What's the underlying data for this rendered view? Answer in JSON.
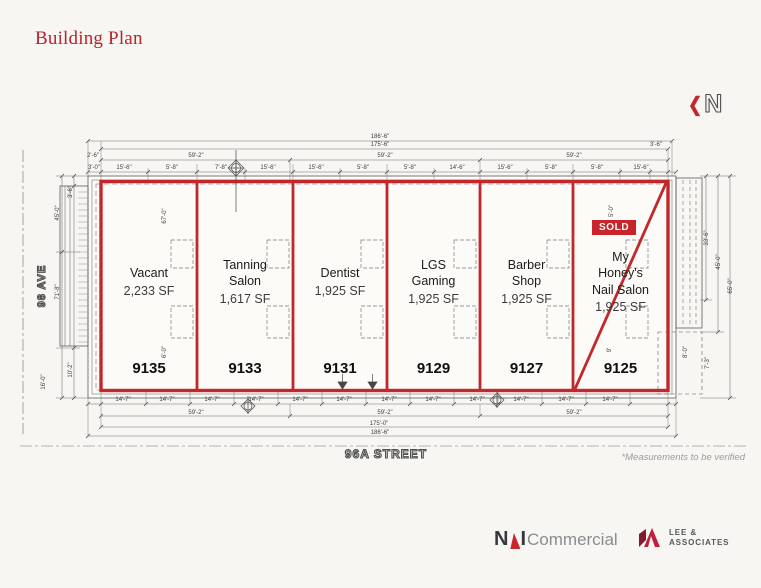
{
  "page": {
    "title": "Building Plan",
    "background": "#f7f6f3",
    "accent_red": "#b3262c",
    "plan_red": "#c2282b"
  },
  "north": {
    "label": "N",
    "arrow_icon": "❮"
  },
  "streets": {
    "left": "98 AVE",
    "bottom": "96A STREET"
  },
  "note": "*Measurements to be verified",
  "units": [
    {
      "number": "9135",
      "lines": [
        "Vacant"
      ],
      "sf": "2,233 SF",
      "status": "",
      "x": 101,
      "w": 96
    },
    {
      "number": "9133",
      "lines": [
        "Tanning",
        "Salon"
      ],
      "sf": "1,617 SF",
      "status": "",
      "x": 197,
      "w": 96
    },
    {
      "number": "9131",
      "lines": [
        "Dentist"
      ],
      "sf": "1,925 SF",
      "status": "",
      "x": 293,
      "w": 94
    },
    {
      "number": "9129",
      "lines": [
        "LGS",
        "Gaming"
      ],
      "sf": "1,925 SF",
      "status": "",
      "x": 387,
      "w": 93
    },
    {
      "number": "9127",
      "lines": [
        "Barber",
        "Shop"
      ],
      "sf": "1,925 SF",
      "status": "",
      "x": 480,
      "w": 93
    },
    {
      "number": "9125",
      "lines": [
        "My",
        "Honey's",
        "Nail Salon"
      ],
      "sf": "1,925 SF",
      "status": "SOLD",
      "x": 573,
      "w": 95
    }
  ],
  "dimensions": {
    "overall_width": "186'-6\"",
    "labels": [
      {
        "t": "186'-6\"",
        "x": 380,
        "y": 137
      },
      {
        "t": "175'-6\"",
        "x": 380,
        "y": 145
      },
      {
        "t": "2'-6\"",
        "x": 93,
        "y": 156
      },
      {
        "t": "59'-2\"",
        "x": 196,
        "y": 156
      },
      {
        "t": "59'-2\"",
        "x": 385,
        "y": 156
      },
      {
        "t": "59'-2\"",
        "x": 574,
        "y": 156
      },
      {
        "t": "3'-6\"",
        "x": 656,
        "y": 145
      },
      {
        "t": "3'-0\"",
        "x": 94,
        "y": 168
      },
      {
        "t": "15'-6\"",
        "x": 124,
        "y": 168
      },
      {
        "t": "5'-8\"",
        "x": 172,
        "y": 168
      },
      {
        "t": "7'-8\"",
        "x": 221,
        "y": 168
      },
      {
        "t": "15'-6\"",
        "x": 268,
        "y": 168
      },
      {
        "t": "15'-6\"",
        "x": 316,
        "y": 168
      },
      {
        "t": "5'-8\"",
        "x": 363,
        "y": 168
      },
      {
        "t": "5'-8\"",
        "x": 410,
        "y": 168
      },
      {
        "t": "14'-6\"",
        "x": 457,
        "y": 168
      },
      {
        "t": "15'-6\"",
        "x": 505,
        "y": 168
      },
      {
        "t": "5'-8\"",
        "x": 551,
        "y": 168
      },
      {
        "t": "5'-8\"",
        "x": 597,
        "y": 168
      },
      {
        "t": "15'-6\"",
        "x": 641,
        "y": 168
      },
      {
        "t": "14'-7\"",
        "x": 123,
        "y": 400
      },
      {
        "t": "14'-7\"",
        "x": 167,
        "y": 400
      },
      {
        "t": "14'-7\"",
        "x": 212,
        "y": 400
      },
      {
        "t": "14'-7\"",
        "x": 256,
        "y": 400
      },
      {
        "t": "14'-7\"",
        "x": 300,
        "y": 400
      },
      {
        "t": "14'-7\"",
        "x": 344,
        "y": 400
      },
      {
        "t": "14'-7\"",
        "x": 389,
        "y": 400
      },
      {
        "t": "14'-7\"",
        "x": 433,
        "y": 400
      },
      {
        "t": "14'-7\"",
        "x": 477,
        "y": 400
      },
      {
        "t": "14'-7\"",
        "x": 521,
        "y": 400
      },
      {
        "t": "14'-7\"",
        "x": 566,
        "y": 400
      },
      {
        "t": "14'-7\"",
        "x": 610,
        "y": 400
      },
      {
        "t": "59'-2\"",
        "x": 196,
        "y": 413
      },
      {
        "t": "59'-2\"",
        "x": 385,
        "y": 413
      },
      {
        "t": "59'-2\"",
        "x": 574,
        "y": 413
      },
      {
        "t": "175'-0\"",
        "x": 379,
        "y": 424
      },
      {
        "t": "186'-6\"",
        "x": 380,
        "y": 433
      },
      {
        "t": "3'-6\"",
        "x": 71,
        "y": 192,
        "r": -90
      },
      {
        "t": "45'-0\"",
        "x": 58,
        "y": 213,
        "r": -90
      },
      {
        "t": "71'-8\"",
        "x": 58,
        "y": 292,
        "r": -90
      },
      {
        "t": "10'-2\"",
        "x": 71,
        "y": 370,
        "r": -90
      },
      {
        "t": "16'-0\"",
        "x": 44,
        "y": 382,
        "r": -90
      },
      {
        "t": "67'-0\"",
        "x": 165,
        "y": 216,
        "r": -90
      },
      {
        "t": "6'-0\"",
        "x": 165,
        "y": 352,
        "r": -90
      },
      {
        "t": "5'-0\"",
        "x": 612,
        "y": 211,
        "r": -90
      },
      {
        "t": "9'",
        "x": 610,
        "y": 350,
        "r": -90
      },
      {
        "t": "33'-6\"",
        "x": 707,
        "y": 238,
        "r": -90
      },
      {
        "t": "45'-0\"",
        "x": 719,
        "y": 262,
        "r": -90
      },
      {
        "t": "65'-0\"",
        "x": 731,
        "y": 286,
        "r": -90
      },
      {
        "t": "7'-3\"",
        "x": 708,
        "y": 363,
        "r": -90
      },
      {
        "t": "8'-0\"",
        "x": 686,
        "y": 352,
        "r": -90
      }
    ]
  },
  "nai_logo": {
    "n": "N",
    "i": "I",
    "word": "Commercial"
  },
  "lee_logo": {
    "line1": "LEE &",
    "line2": "ASSOCIATES"
  }
}
